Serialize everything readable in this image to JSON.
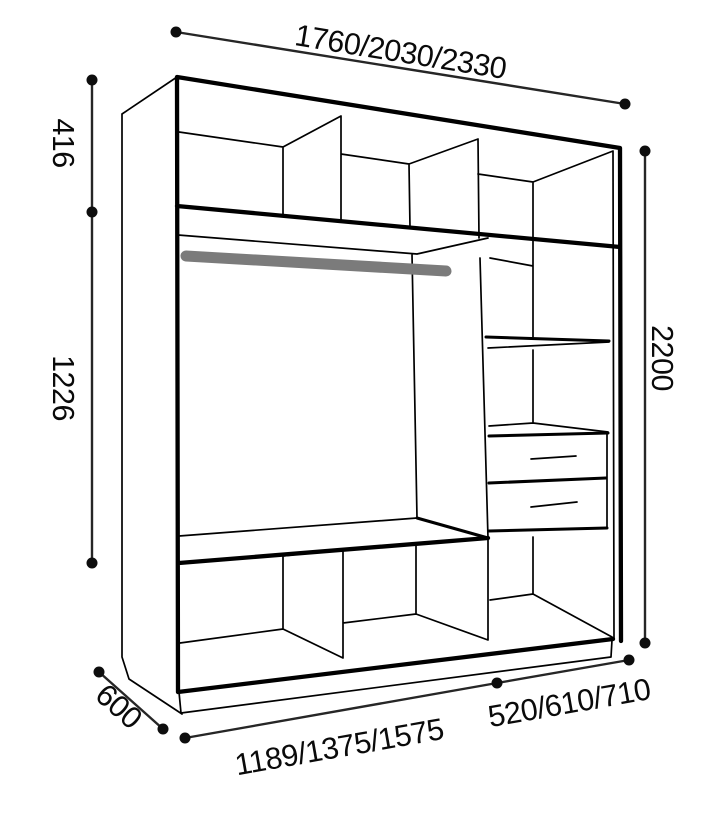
{
  "diagram": {
    "kind": "wardrobe-interior-dimension-drawing",
    "colors": {
      "background": "#ffffff",
      "cabinet_line": "#000000",
      "dimension_line": "#262626",
      "dimension_dot": "#0d0d0d",
      "hanging_rail": "#7b7b7b"
    },
    "labels": {
      "width_options": "1760/2030/2330",
      "top_section_height": "416",
      "hanging_section_height": "1226",
      "total_height": "2200",
      "depth": "600",
      "left_width_options": "1189/1375/1575",
      "right_width_options": "520/610/710"
    }
  }
}
